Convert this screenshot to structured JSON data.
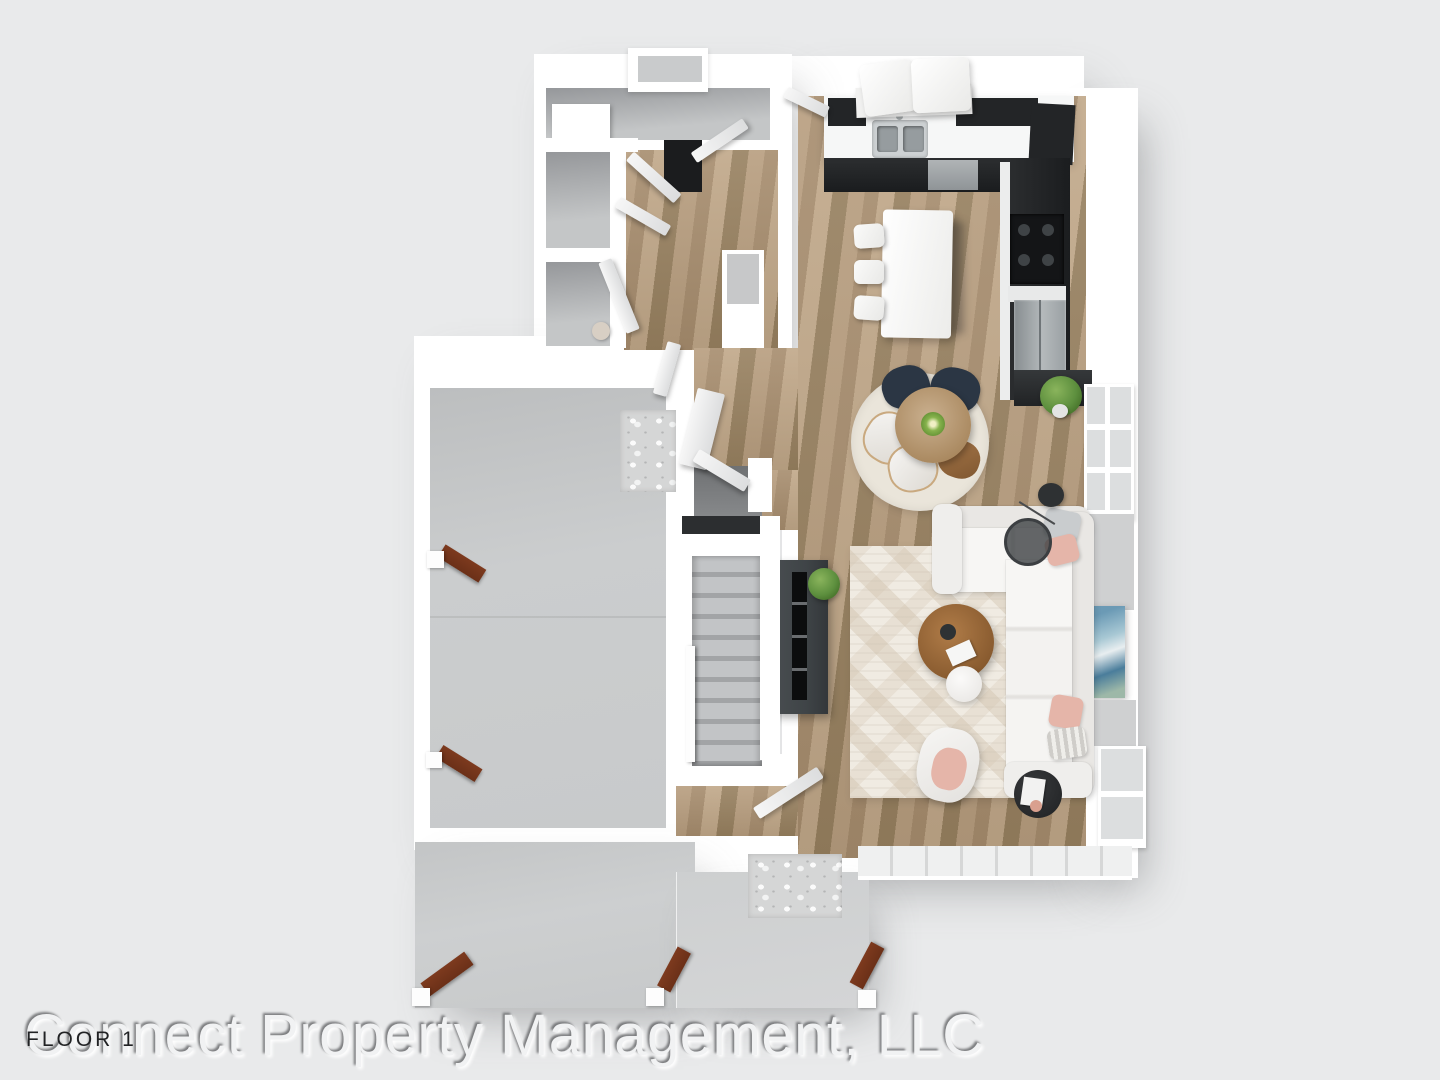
{
  "watermark": "Connect Property Management, LLC",
  "floor_label": "FLOOR 1",
  "colors": {
    "background": "#e9eaeb",
    "wall": "#ffffff",
    "wood": "#ad9374",
    "wood_dark": "#8d7457",
    "concrete": "#c9cbcc",
    "concrete_light": "#d0d2d3",
    "gray_floor": "#b2b4b6",
    "cabinet_dark": "#232527",
    "stainless": "#a3a8ab",
    "rug": "#f0ebe2",
    "rug_round": "#eae5da",
    "sofa": "#f5f4f2",
    "navy": "#2b3644",
    "table_wood": "#b89a76",
    "stairs_light": "#c2c4c6",
    "stairs_dark": "#a2a4a6",
    "tv_console": "#3f4447",
    "plant_green": "#5d8f3e",
    "pink": "#e5b5a9",
    "art_blue": "#6b9ab5",
    "beam_brown": "#6b3018",
    "label_dark": "#212224",
    "watermark_fill": "#f1f2f3"
  }
}
